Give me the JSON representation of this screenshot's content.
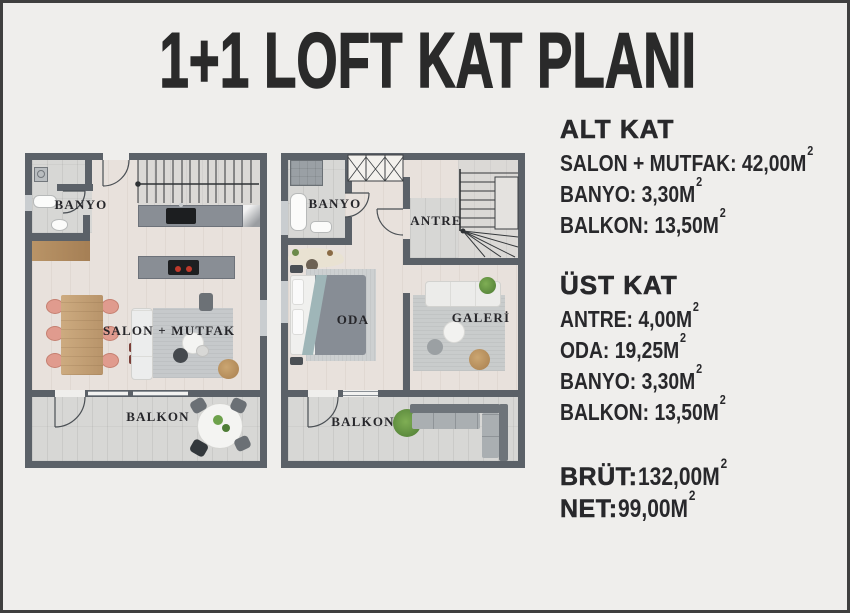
{
  "title": "1+1 LOFT KAT PLANI",
  "specs": {
    "sections": [
      {
        "heading": "ALT KAT",
        "items": [
          {
            "text": "SALON + MUTFAK: 42,00M",
            "sup": "2"
          },
          {
            "text": "BANYO: 3,30M",
            "sup": "2"
          },
          {
            "text": "BALKON: 13,50M",
            "sup": "2"
          }
        ]
      },
      {
        "heading": "ÜST KAT",
        "items": [
          {
            "text": "ANTRE: 4,00M",
            "sup": "2"
          },
          {
            "text": "ODA: 19,25M",
            "sup": "2"
          },
          {
            "text": "BANYO: 3,30M",
            "sup": "2"
          },
          {
            "text": "BALKON: 13,50M",
            "sup": "2"
          }
        ]
      }
    ],
    "totals": [
      {
        "label": "BRÜT:",
        "value": " 132,00M",
        "sup": "2"
      },
      {
        "label": "NET:",
        "value": " 99,00M",
        "sup": "2"
      }
    ]
  },
  "plans": {
    "left": {
      "name": "alt-kat-plani",
      "labels": {
        "banyo": "BANYO",
        "salon": "SALON + MUTFAK",
        "balkon": "BALKON"
      }
    },
    "right": {
      "name": "ust-kat-plani",
      "labels": {
        "banyo": "BANYO",
        "antre": "ANTRE",
        "oda": "ODA",
        "galeri": "GALERİ",
        "balkon": "BALKON"
      }
    }
  },
  "colors": {
    "background": "#efeeec",
    "page_border": "#3f3f3f",
    "text": "#28282b",
    "wall": "#5b6168",
    "wood_floor": "#e8e1dc",
    "tile_floor": "#d7d7d5",
    "kitchen_counter": "#898e95",
    "dining_table_wood": "#c3a075",
    "chair_salmon": "#e09b8e",
    "rug": "#c6c9cb",
    "bed_duvet": "#878d95",
    "plant_green": "#6da14b"
  }
}
